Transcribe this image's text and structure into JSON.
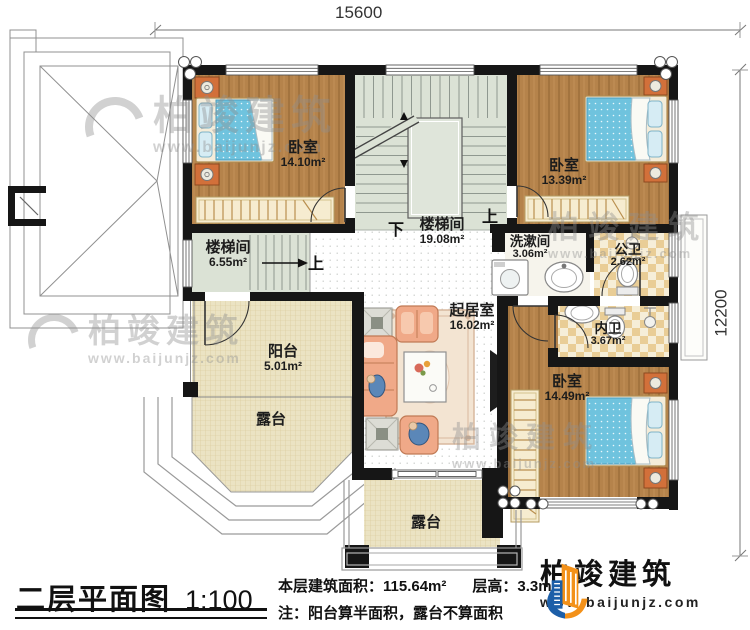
{
  "dims": {
    "width": "15600",
    "depth": "12200"
  },
  "rooms": {
    "bedroom1": {
      "name": "卧室",
      "area": "14.10m²"
    },
    "bedroom2": {
      "name": "卧室",
      "area": "13.39m²"
    },
    "bedroom3": {
      "name": "卧室",
      "area": "14.49m²"
    },
    "stair_main": {
      "name": "楼梯间",
      "area": "19.08m²"
    },
    "stair_small": {
      "name": "楼梯间",
      "area": "6.55m²"
    },
    "washroom": {
      "name": "洗漱间",
      "area": "3.06m²"
    },
    "public_bath": {
      "name": "公卫",
      "area": "2.62m²"
    },
    "private_bath": {
      "name": "内卫",
      "area": "3.67m²"
    },
    "living": {
      "name": "起居室",
      "area": "16.02m²"
    },
    "balcony": {
      "name": "阳台",
      "area": "5.01m²"
    },
    "terrace_left": {
      "name": "露台"
    },
    "terrace_bottom": {
      "name": "露台"
    }
  },
  "stairs": {
    "up_main": "上",
    "down_main": "下",
    "up_small": "上"
  },
  "watermark": {
    "brand": "柏竣建筑",
    "site": "www.baijunjz.com"
  },
  "footer": {
    "title": "二层平面图",
    "scale": "1:100",
    "area_label": "本层建筑面积：115.64m²",
    "height_label": "层高：3.3m",
    "note": "注：阳台算半面积，露台不算面积",
    "brand": "柏竣建筑",
    "site": "www.baijunjz.com"
  },
  "colors": {
    "wall": "#161616",
    "wood": "#b5834b",
    "stair_floor": "#dbe2d5",
    "terrace_floor": "#ece4c2",
    "bath_tile": "#e9cd96",
    "bed_blue": "#6fc3de",
    "sofa": "#f0a988",
    "brand_blue": "#1d5fa8",
    "brand_orange": "#f39119"
  }
}
